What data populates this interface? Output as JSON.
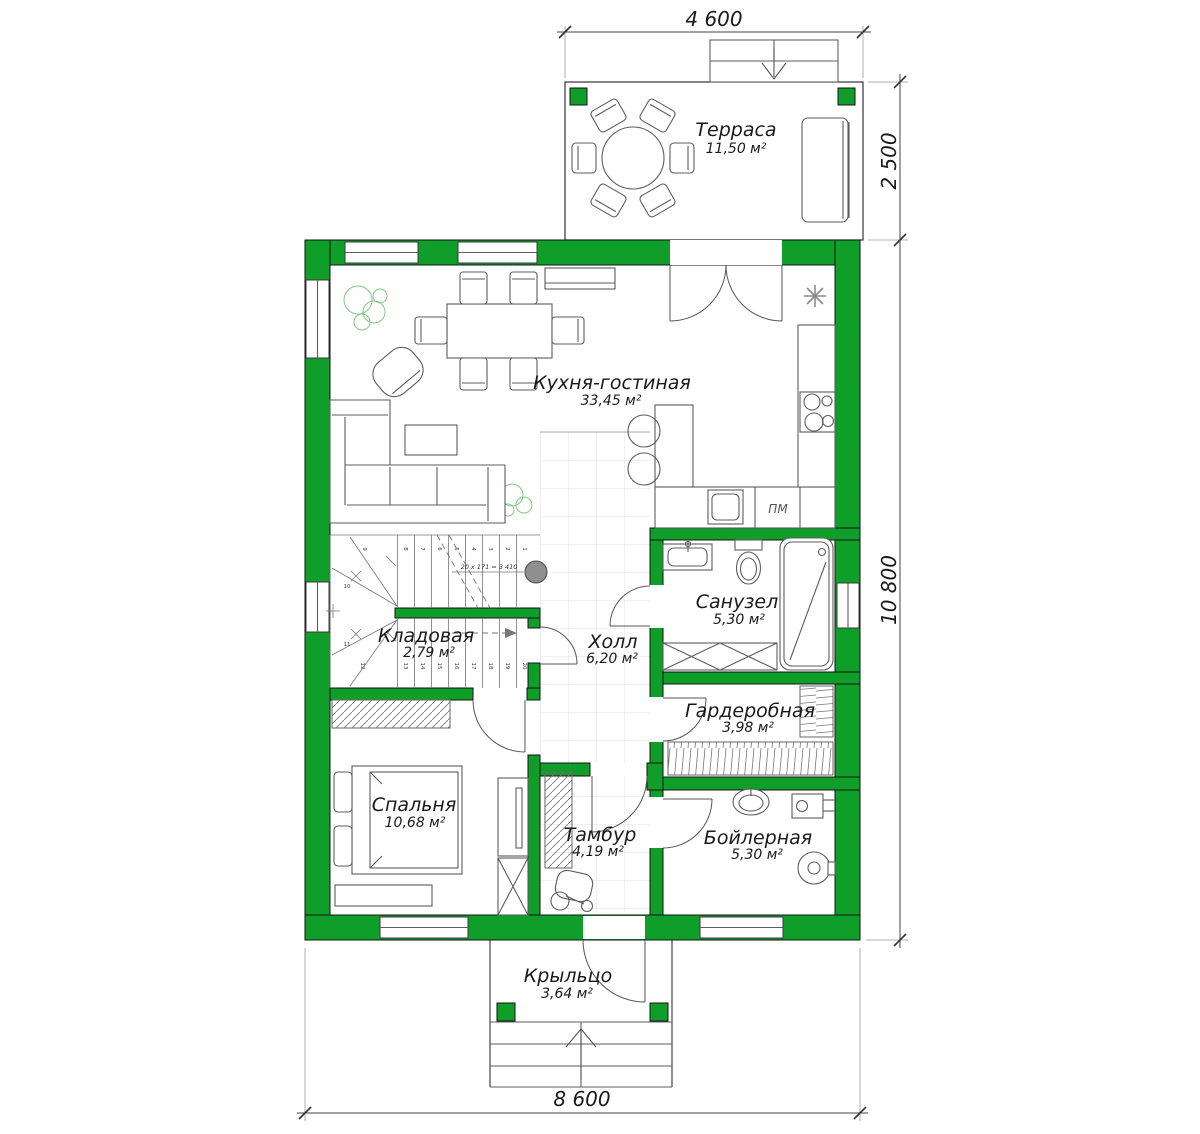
{
  "plan": {
    "rooms": {
      "terrace": {
        "name": "Терраса",
        "area": "11,50 м²"
      },
      "kitchen_living": {
        "name": "Кухня-гостиная",
        "area": "33,45 м²"
      },
      "bathroom": {
        "name": "Санузел",
        "area": "5,30 м²"
      },
      "storage": {
        "name": "Кладовая",
        "area": "2,79 м²"
      },
      "hall": {
        "name": "Холл",
        "area": "6,20 м²"
      },
      "wardrobe": {
        "name": "Гардеробная",
        "area": "3,98 м²"
      },
      "bedroom": {
        "name": "Спальня",
        "area": "10,68 м²"
      },
      "vestibule": {
        "name": "Тамбур",
        "area": "4,19 м²"
      },
      "boiler": {
        "name": "Бойлерная",
        "area": "5,30 м²"
      },
      "porch": {
        "name": "Крыльцо",
        "area": "3,64 м²"
      }
    },
    "dimensions": {
      "top_width": "4 600",
      "terrace_depth": "2 500",
      "house_depth": "10 800",
      "house_width": "8 600"
    },
    "stairs": {
      "formula": "20 x 171 = 3 410",
      "step_numbers": [
        "1",
        "2",
        "3",
        "4",
        "5",
        "6",
        "7",
        "8",
        "9",
        "10",
        "11",
        "12",
        "13",
        "14",
        "15",
        "16",
        "17",
        "18",
        "19",
        "20"
      ]
    },
    "appliances": {
      "dishwasher": "ПМ"
    },
    "colors": {
      "wall_green": "#109e2b",
      "plant_green": "#84c884",
      "line_gray": "#5d5d5d"
    }
  }
}
